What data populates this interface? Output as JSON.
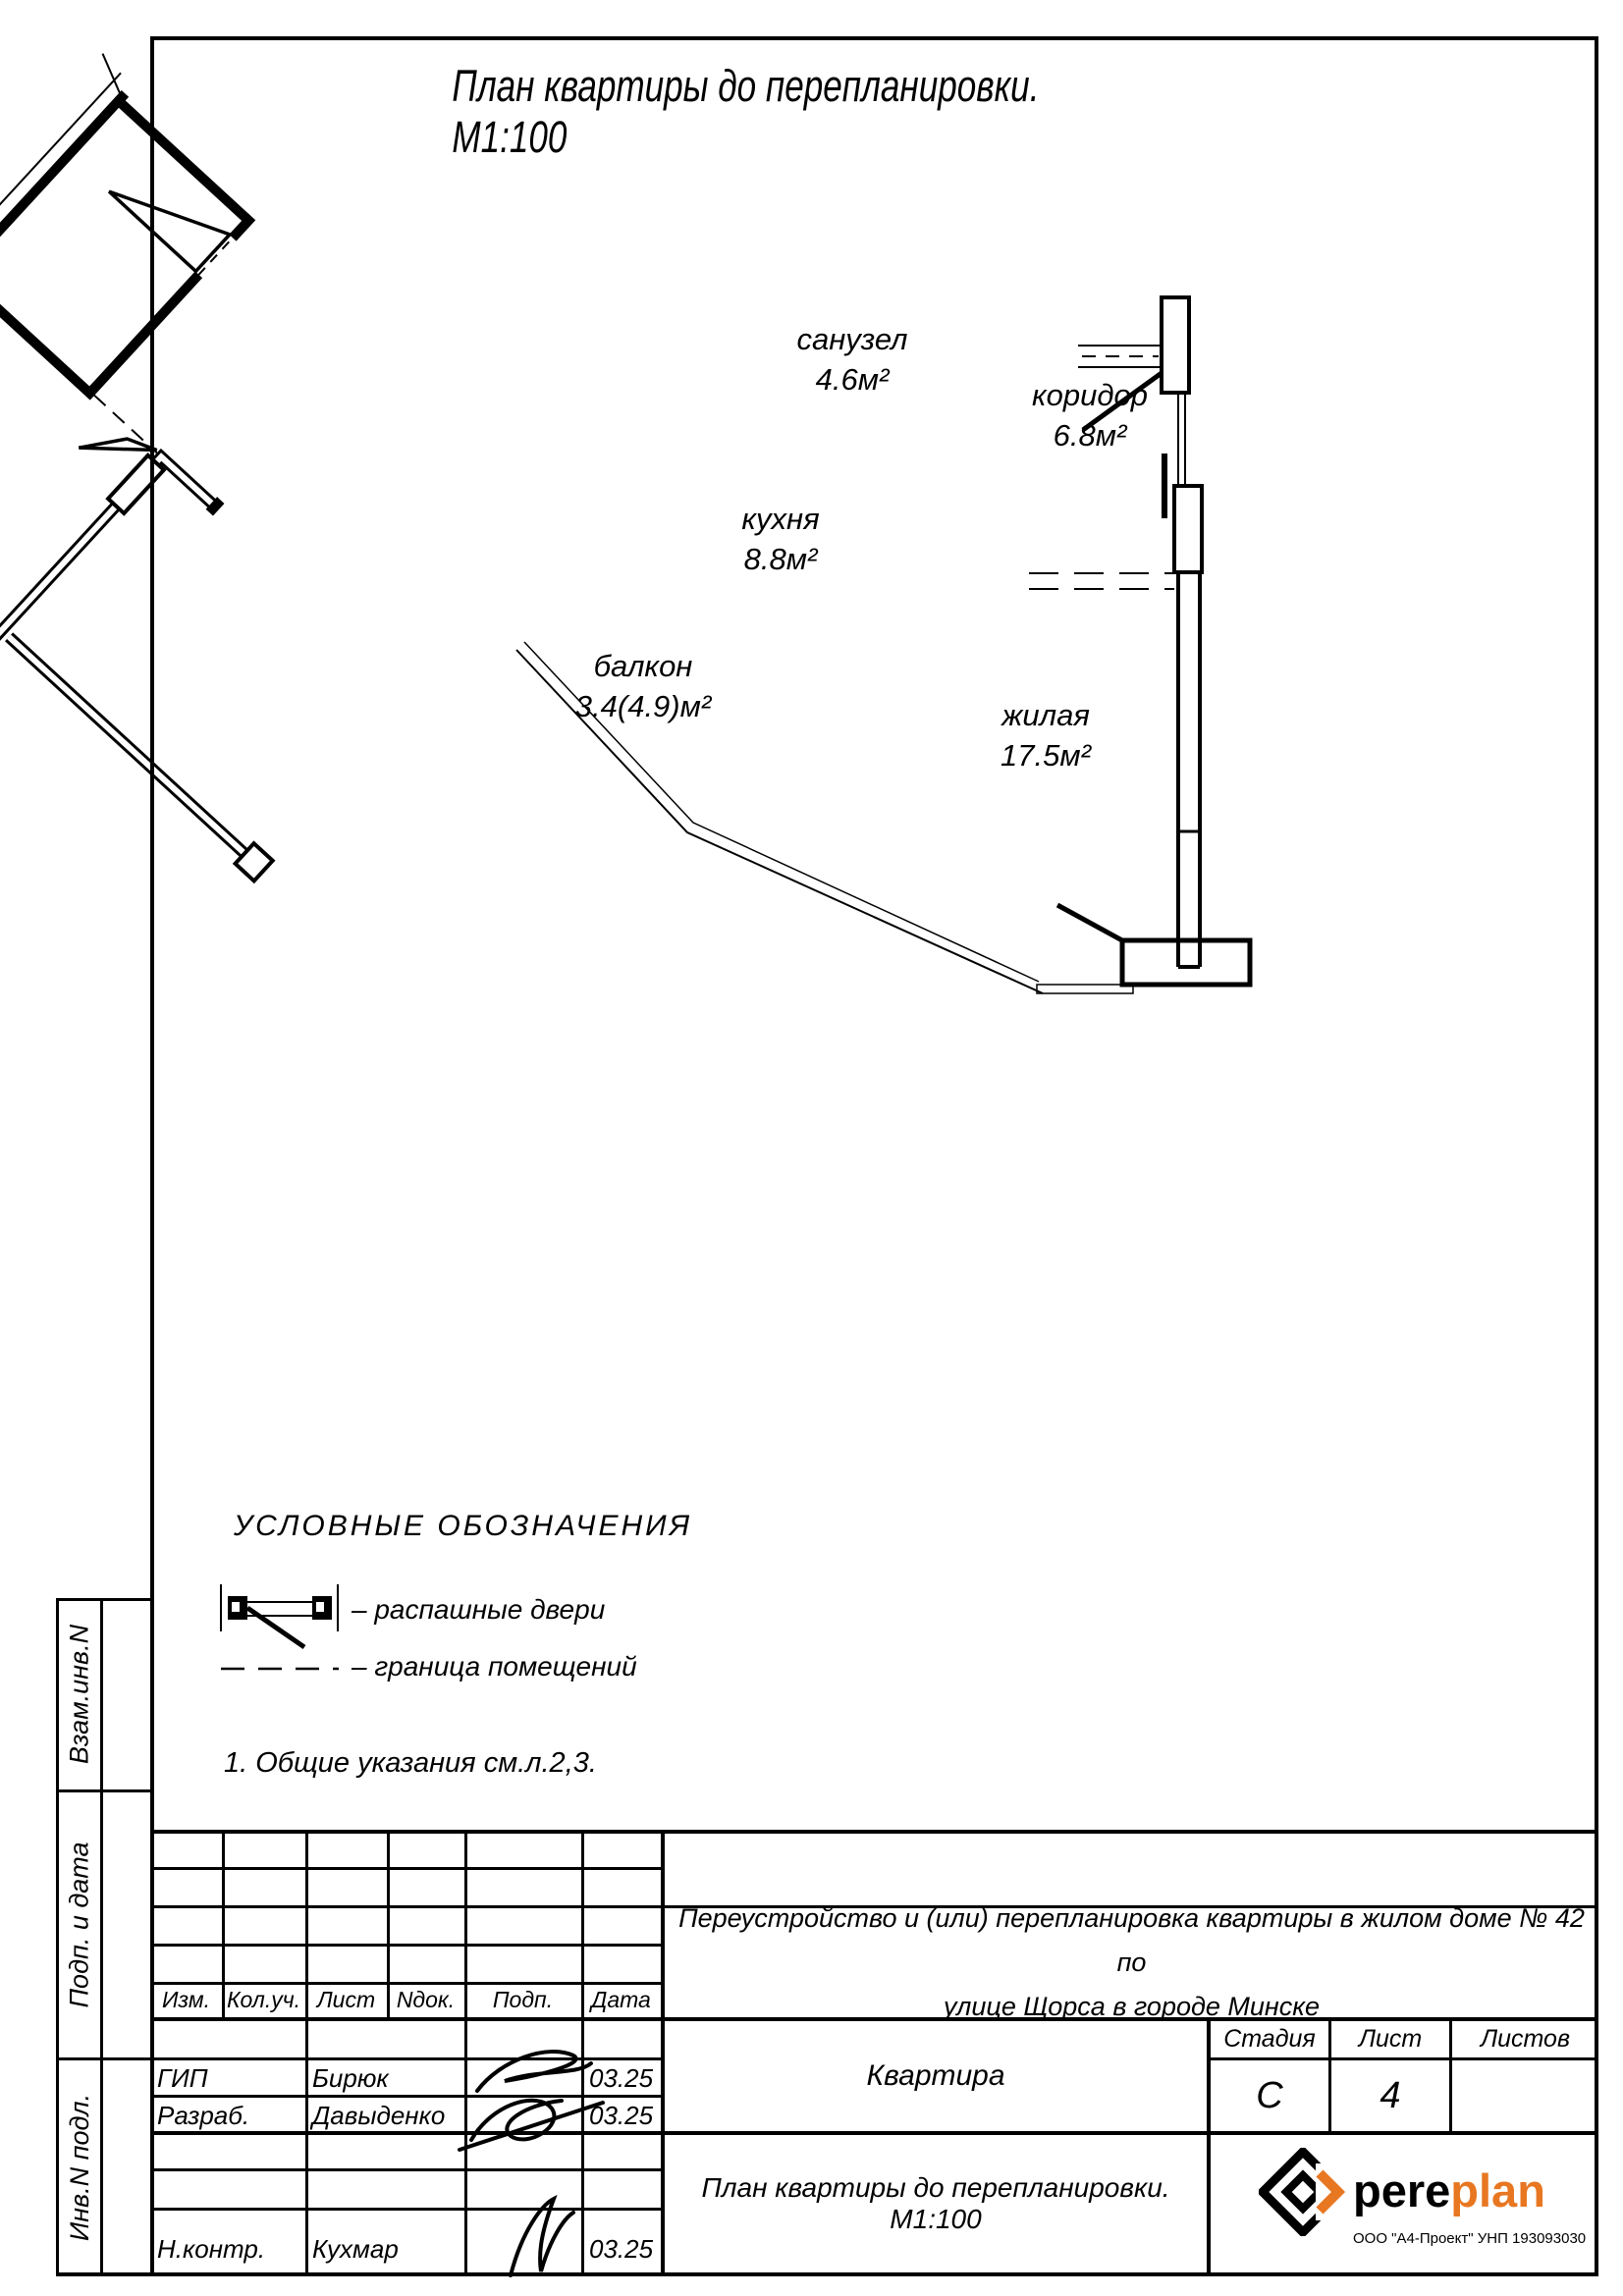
{
  "title": "План квартиры до перепланировки. М1:100",
  "plan": {
    "rooms": [
      {
        "name": "санузел",
        "area": "4.6м²"
      },
      {
        "name": "коридор",
        "area": "6.8м²"
      },
      {
        "name": "кухня",
        "area": "8.8м²"
      },
      {
        "name": "балкон",
        "area": "3.4(4.9)м²"
      },
      {
        "name": "жилая",
        "area": "17.5м²"
      }
    ]
  },
  "legend": {
    "heading": "УСЛОВНЫЕ ОБОЗНАЧЕНИЯ",
    "items": [
      {
        "symbol": "swing-doors-symbol",
        "label": "– распашные двери"
      },
      {
        "symbol": "room-boundary-dashed",
        "label": "– граница помещений"
      }
    ],
    "note": "1. Общие указания см.л.2,3."
  },
  "sidebar": [
    "Взам.инв.N",
    "Подп. и дата",
    "Инв.N подл."
  ],
  "title_block": {
    "columns": [
      "Изм.",
      "Кол.уч.",
      "Лист",
      "Nдок.",
      "Подп.",
      "Дата"
    ],
    "rows": [
      {
        "role": "ГИП",
        "name": "Бирюк",
        "date": "03.25"
      },
      {
        "role": "Разраб.",
        "name": "Давыденко",
        "date": "03.25"
      },
      {
        "role": "Н.контр.",
        "name": "Кухмар",
        "date": "03.25"
      }
    ],
    "project_line1": "Переустройство и (или) перепланировка квартиры в жилом доме № 42 по",
    "project_line2": "улице Щорса в городе Минске",
    "object": "Квартира",
    "stage_label": "Стадия",
    "stage": "С",
    "sheet_label": "Лист",
    "sheet": "4",
    "sheets_label": "Листов",
    "sheets": "",
    "doc_title": "План квартиры до перепланировки. М1:100",
    "logo": {
      "brand_pere": "pere",
      "brand_plan": "plan",
      "sub": "ООО \"А4-Проект\" УНП 193093030",
      "accent": "#e87722"
    }
  },
  "colors": {
    "ink": "#000000",
    "accent": "#e87722"
  }
}
